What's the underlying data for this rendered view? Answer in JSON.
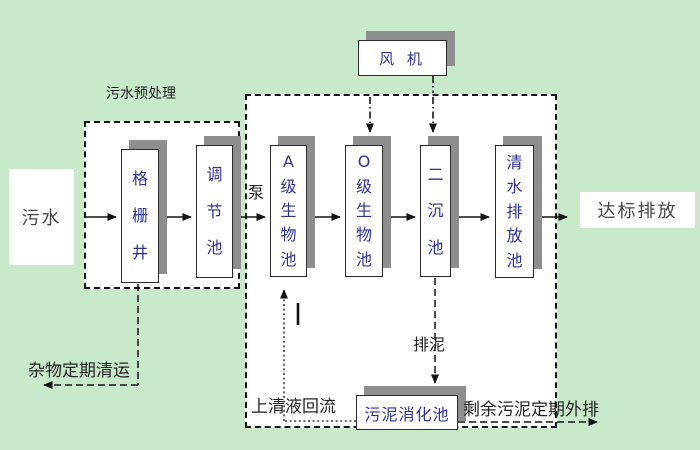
{
  "groups": {
    "pretreatment": {
      "label": "污水预处理"
    }
  },
  "nodes": {
    "influent": {
      "label": "污水"
    },
    "grid_well": {
      "label": "格栅井"
    },
    "regulating_tank": {
      "label": "调节池"
    },
    "a_bio_tank": {
      "label": "A级生物池"
    },
    "o_bio_tank": {
      "label": "O级生物池"
    },
    "secondary_sedimentation_tank": {
      "label": "二沉池"
    },
    "clear_water_discharge_tank": {
      "label": "清水排放池"
    },
    "blower": {
      "label": "风 机"
    },
    "sludge_digestion_tank": {
      "label": "污泥消化池"
    },
    "discharge_outlet": {
      "label": "达标排放"
    }
  },
  "flow_labels": {
    "pump": "泵",
    "debris_removal": "杂物定期清运",
    "supernatant_return": "上清液回流",
    "sludge_discharge": "排泥",
    "excess_sludge_out": "剩余污泥定期外排"
  },
  "colors": {
    "background": "#c9e9cb",
    "node_fill": "#ffffff",
    "node_border": "#2b2b2b",
    "node_text": "#2e3192",
    "shadow": "#8e8e8e",
    "label_text": "#222222",
    "line": "#141414"
  }
}
